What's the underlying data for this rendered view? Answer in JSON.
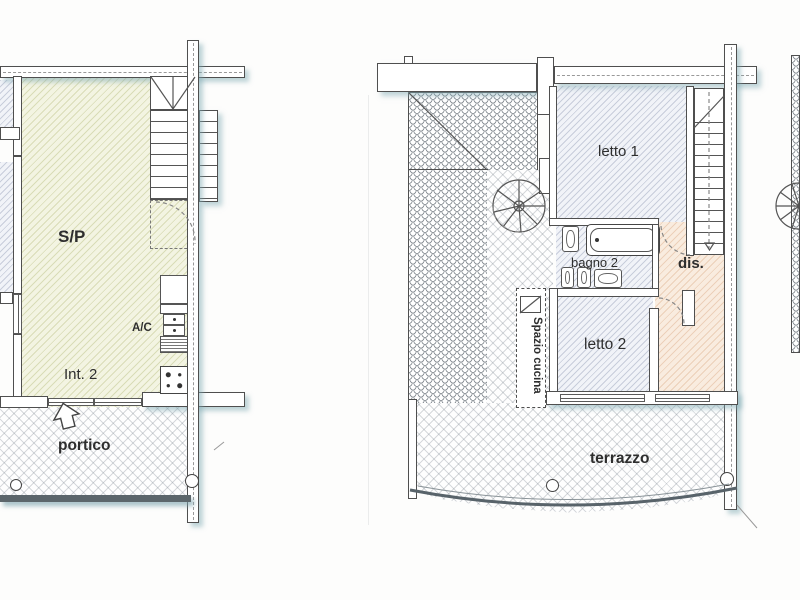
{
  "document": {
    "type": "scanned floor plan drawing, two apartment levels",
    "background": "#fdfdfc"
  },
  "colors": {
    "wall_line": "#4f4f4f",
    "living_fill": "#f3f4e2",
    "living_hatch": "#babf82",
    "bedroom_fill": "#f1f3f8",
    "bedroom_hatch": "#8a94af",
    "hall_fill": "#f9ecdf",
    "hall_hatch": "#d8a680",
    "paving_hatch": "#78828c",
    "roof_tile_line": "#8f959b",
    "shadow": "rgba(125,170,180,0.5)",
    "label_text": "#2e2e2e"
  },
  "left_plan": {
    "title": "ground floor unit plan",
    "labels": {
      "living": "S/P",
      "ac": "A/C",
      "unit": "Int. 2",
      "porch": "portico"
    }
  },
  "right_plan": {
    "title": "upper floor plan",
    "labels": {
      "bedroom1": "letto 1",
      "bathroom": "bagno 2",
      "hallway": "dis.",
      "bedroom2": "letto 2",
      "kitchen_space": "Spazio cucina",
      "terrace": "terrazzo"
    }
  }
}
